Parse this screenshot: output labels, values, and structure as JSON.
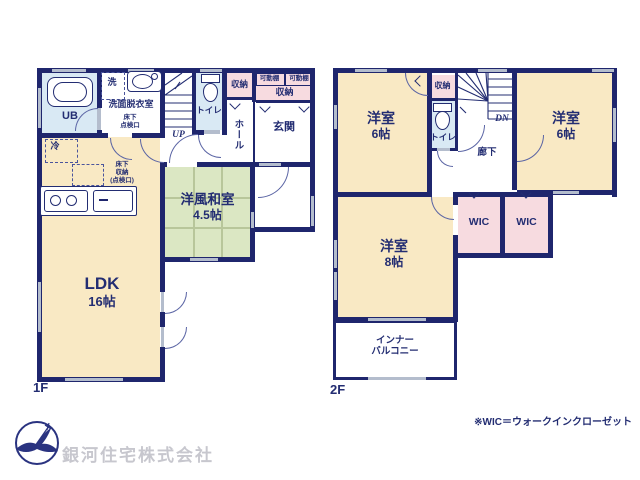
{
  "document": {
    "type": "japanese-real-estate-floor-plan"
  },
  "floors": {
    "f1": {
      "label": "1F",
      "rooms": {
        "ub": "UB",
        "laundry_mark": "洗",
        "washroom": "洗面脱衣室",
        "hatch_line1": "床下",
        "hatch_line2": "点検口",
        "toilet": "トイレ",
        "stairs_up": "UP",
        "closet": "収納",
        "shelf_left": "可動棚",
        "shelf_right": "可動棚",
        "closet_wide": "収納",
        "hall": "ホール",
        "entrance": "玄関",
        "fridge": "冷",
        "floor_storage_line1": "床下",
        "floor_storage_line2": "収納",
        "floor_storage_line3": "(点検口)",
        "japanese_room_name": "洋風和室",
        "japanese_room_size": "4.5帖",
        "ldk_name": "LDK",
        "ldk_size": "16帖"
      }
    },
    "f2": {
      "label": "2F",
      "rooms": {
        "bedroom_left_name": "洋室",
        "bedroom_left_size": "6帖",
        "closet": "収納",
        "toilet": "トイレ",
        "stairs_down": "DN",
        "corridor": "廊下",
        "bedroom_right_name": "洋室",
        "bedroom_right_size": "6帖",
        "bedroom_main_name": "洋室",
        "bedroom_main_size": "8帖",
        "wic_left": "WIC",
        "wic_right": "WIC",
        "balcony_line1": "インナー",
        "balcony_line2": "バルコニー"
      }
    }
  },
  "footer": {
    "company": "銀河住宅株式会社",
    "note": "※WIC＝ウォークインクローゼット"
  },
  "colors": {
    "wall": "#1f266d",
    "text": "#232d72",
    "room_cream": "#f9e9c4",
    "tatami_green": "#dbe7c3",
    "water_blue": "#d9e9f4",
    "closet_pink": "#f7dbe0",
    "window_gray": "#b4bdcd",
    "company_gray": "#c7c7ce"
  }
}
